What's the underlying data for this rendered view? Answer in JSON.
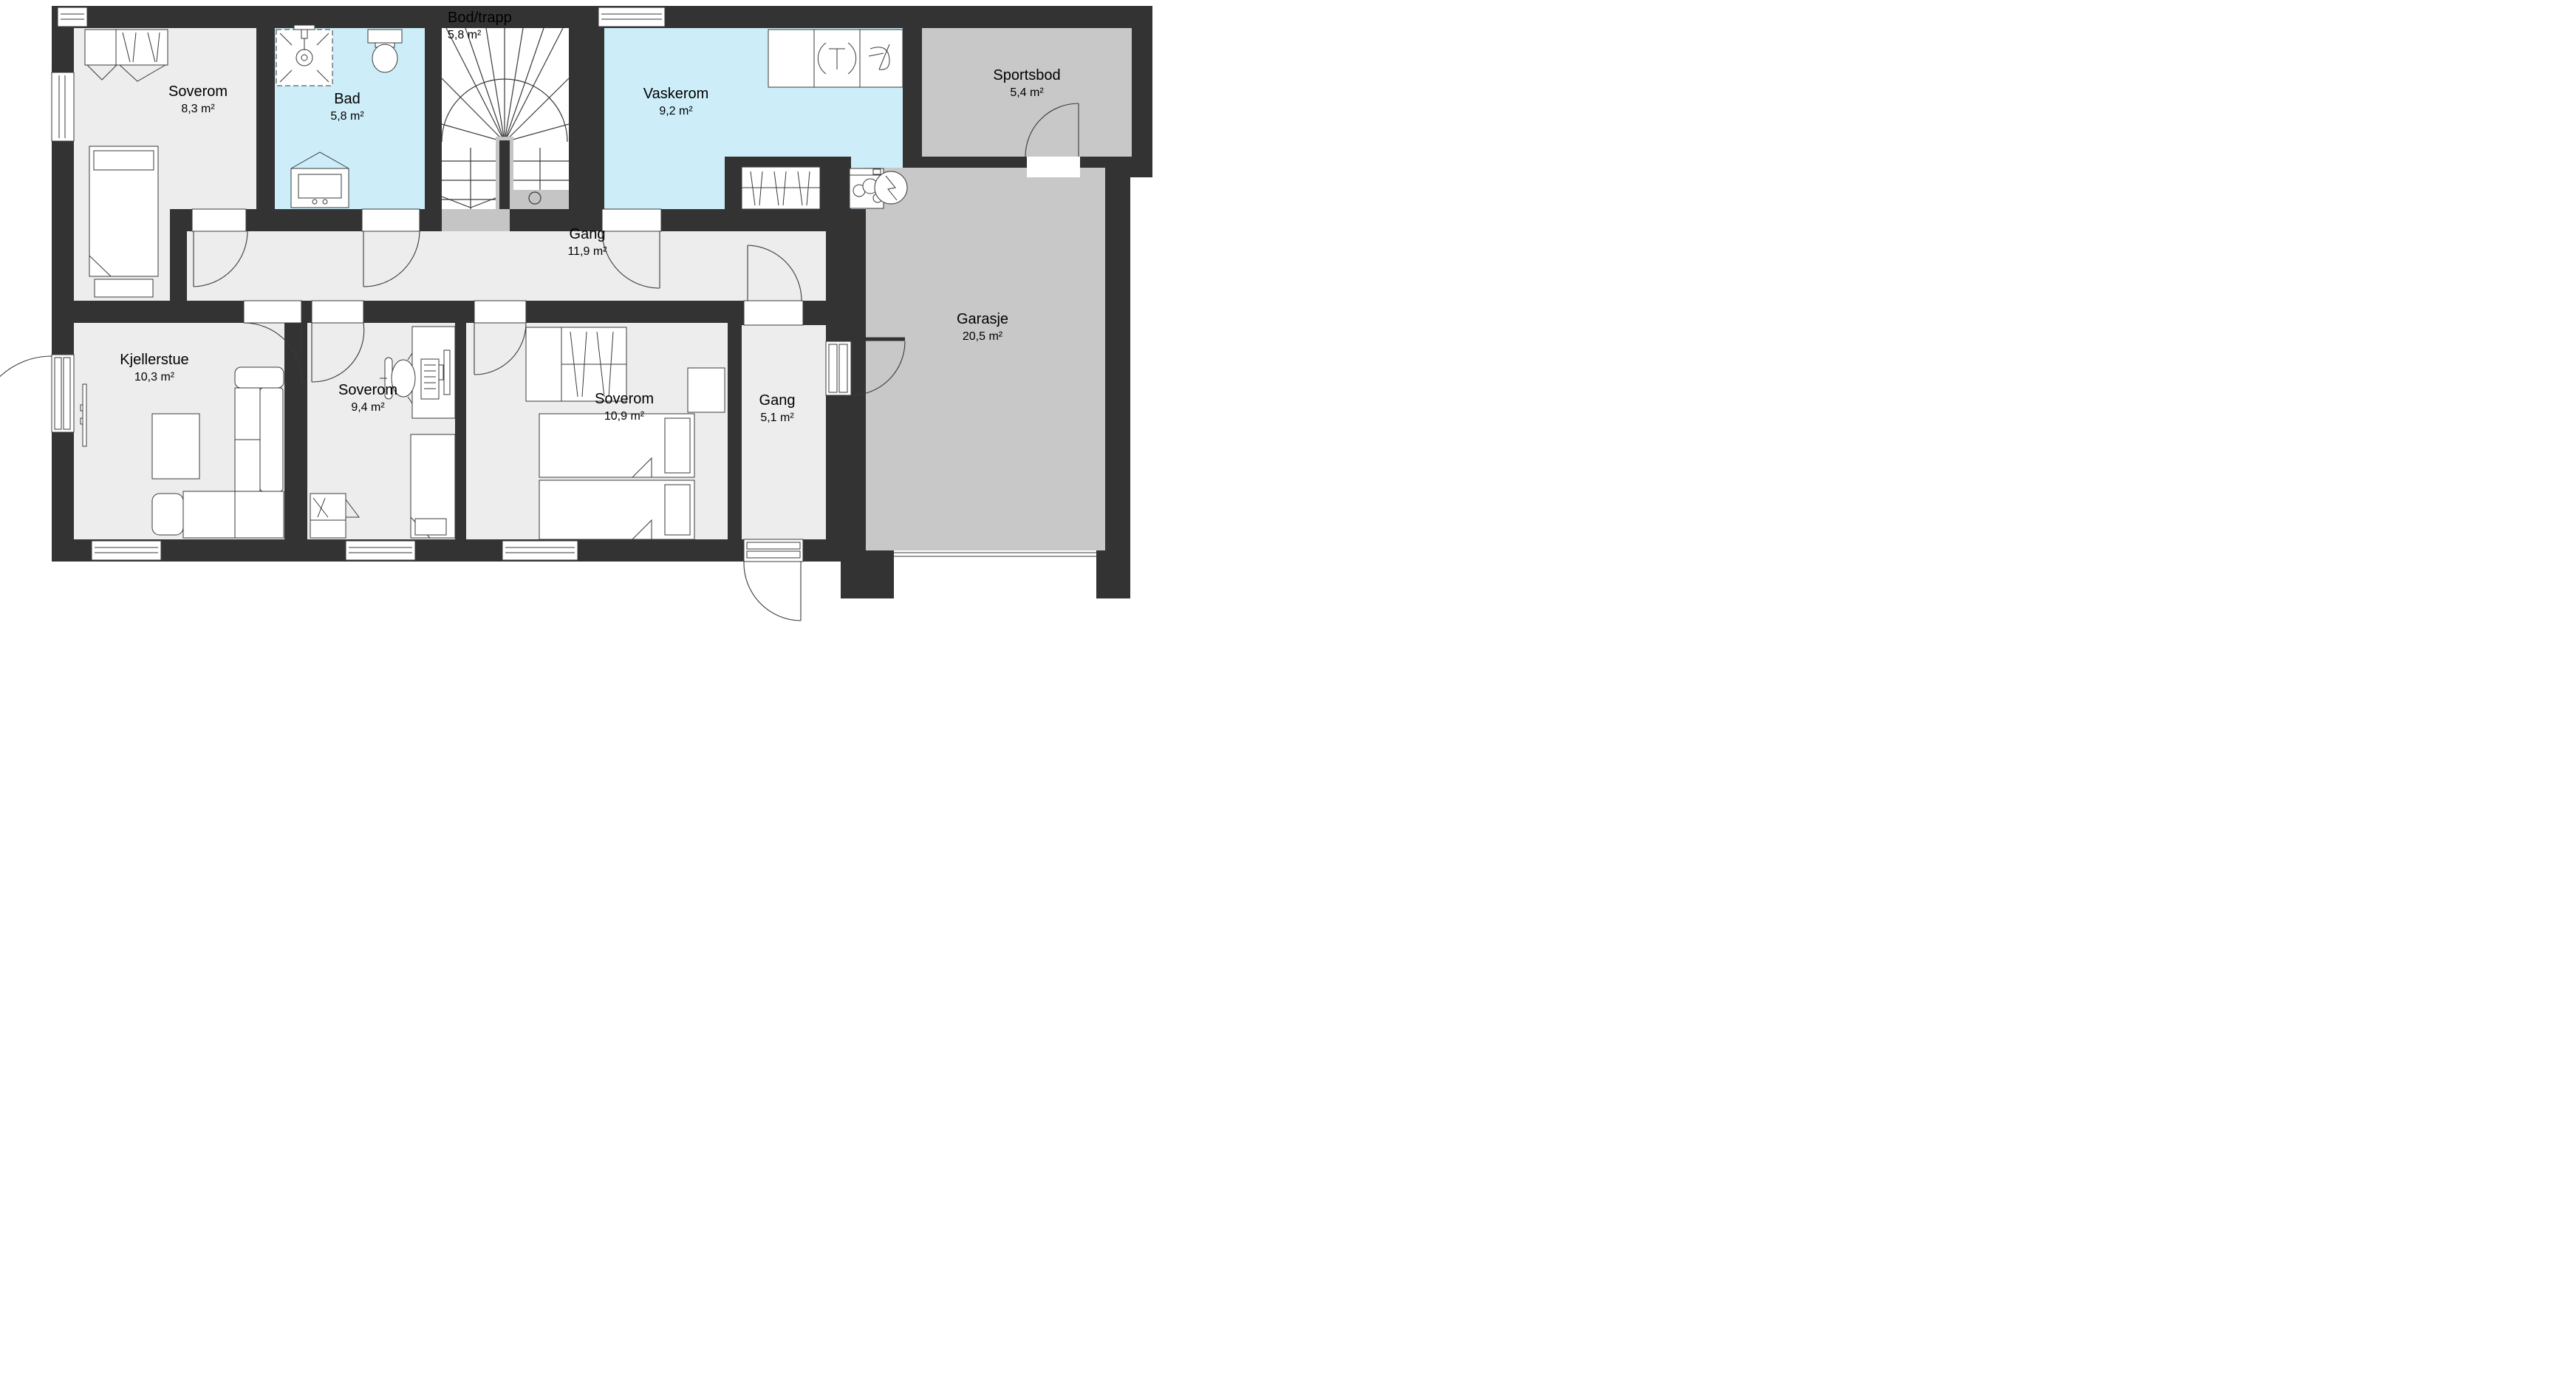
{
  "plan": {
    "type": "floor-plan",
    "language": "Norwegian",
    "colors": {
      "wall": "#333333",
      "floor": "#EDEDEE",
      "wet_room_floor": "#CDEEF9",
      "cold_room_floor": "#C8C8C9",
      "landing": "#C5C5C5",
      "outline": "#3a3a3a",
      "background": "#ffffff",
      "text": "#000000"
    },
    "rooms": {
      "soverom_nw": {
        "name": "Soverom",
        "area": "8,3 m²"
      },
      "bad": {
        "name": "Bad",
        "area": "5,8 m²"
      },
      "bod_trapp": {
        "name": "Bod/trapp",
        "area": "5,8 m²"
      },
      "vaskerom": {
        "name": "Vaskerom",
        "area": "9,2 m²"
      },
      "sportsbod": {
        "name": "Sportsbod",
        "area": "5,4 m²"
      },
      "gang": {
        "name": "Gang",
        "area": "11,9 m²"
      },
      "garasje": {
        "name": "Garasje",
        "area": "20,5 m²"
      },
      "kjellerstue": {
        "name": "Kjellerstue",
        "area": "10,3 m²"
      },
      "soverom_mid": {
        "name": "Soverom",
        "area": "9,4 m²"
      },
      "soverom_se": {
        "name": "Soverom",
        "area": "10,9 m²"
      },
      "gang_small": {
        "name": "Gang",
        "area": "5,1 m²"
      }
    },
    "fixtures": [
      "shower-icon",
      "toilet-icon",
      "bathroom-vanity-icon",
      "sink-icon",
      "dryer-icon",
      "washing-machine-icon",
      "water-heater-icon",
      "stairs-icon",
      "wardrobe-icon",
      "closet-icon",
      "bed-icon",
      "double-bed-icon",
      "sofa-icon",
      "coffee-table-icon",
      "tv-icon",
      "desk-icon",
      "office-chair-icon",
      "dresser-icon",
      "window-icon",
      "door-swing-icon",
      "garage-door-icon"
    ]
  }
}
